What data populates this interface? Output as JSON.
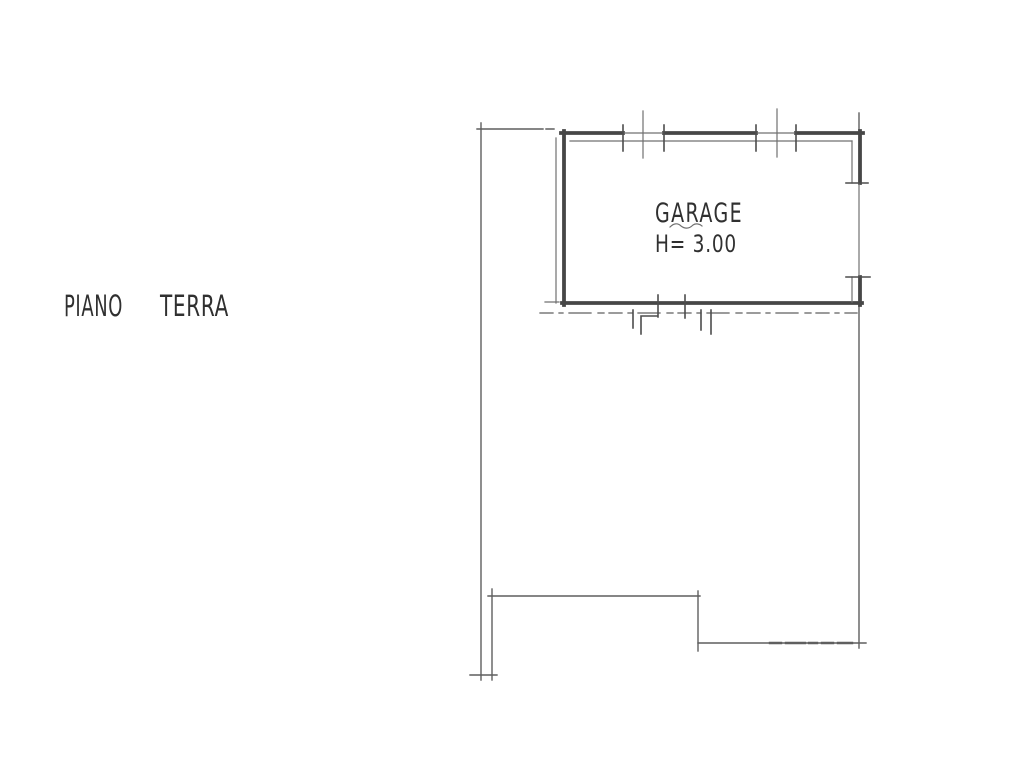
{
  "plan": {
    "floor_label_words": [
      "PIANO",
      "TERRA"
    ],
    "room": {
      "name": "GARAGE",
      "height_note": "H= 3.00"
    },
    "colors": {
      "background": "#ffffff",
      "wall": "#474747",
      "tick": "#4d4d4d",
      "thin_line": "#707070",
      "boundary": "#5f5f5f",
      "text": "#303030"
    }
  }
}
